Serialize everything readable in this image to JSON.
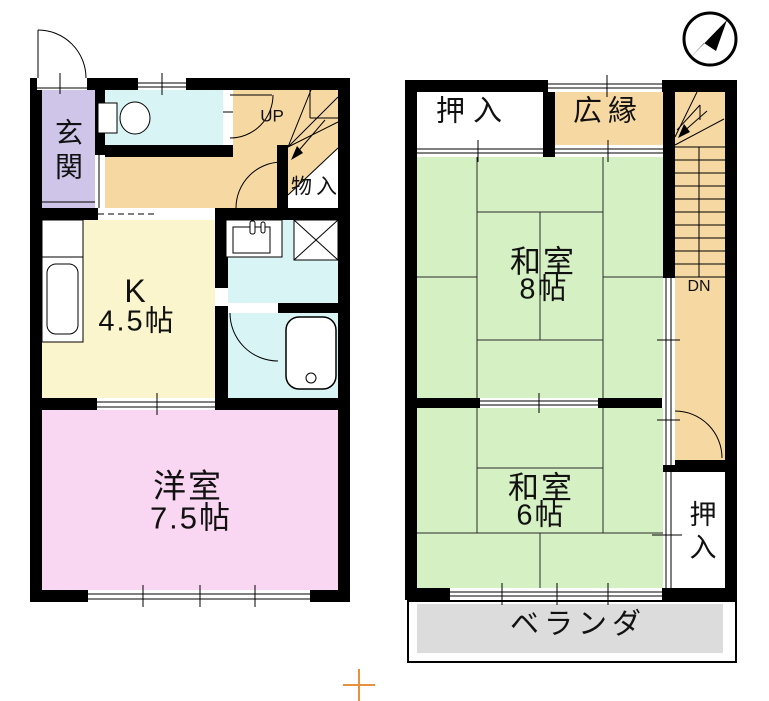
{
  "colors": {
    "wall": "#000000",
    "hallway_stairs": "#F6D8A2",
    "tatami_room": "#D5F1C4",
    "kitchen": "#FBF5CD",
    "western_room": "#F9D6F1",
    "wet_area": "#D8F4F4",
    "entrance": "#CEC5E9",
    "balcony": "#DCDCDC",
    "cross_mark": "#E8913C"
  },
  "floor1": {
    "entrance_label": "玄関",
    "up_label": "UP",
    "storage_label": "物入",
    "kitchen": {
      "name": "K",
      "size": "4.5帖"
    },
    "western_room": {
      "name": "洋室",
      "size": "7.5帖"
    }
  },
  "floor2": {
    "closet_top_label": "押入",
    "sunroom_label": "広縁",
    "tatami8": {
      "name": "和室",
      "size": "8帖"
    },
    "down_label": "DN",
    "tatami6": {
      "name": "和室",
      "size": "6帖"
    },
    "closet_side_label": "押入",
    "balcony_label": "ベランダ"
  }
}
